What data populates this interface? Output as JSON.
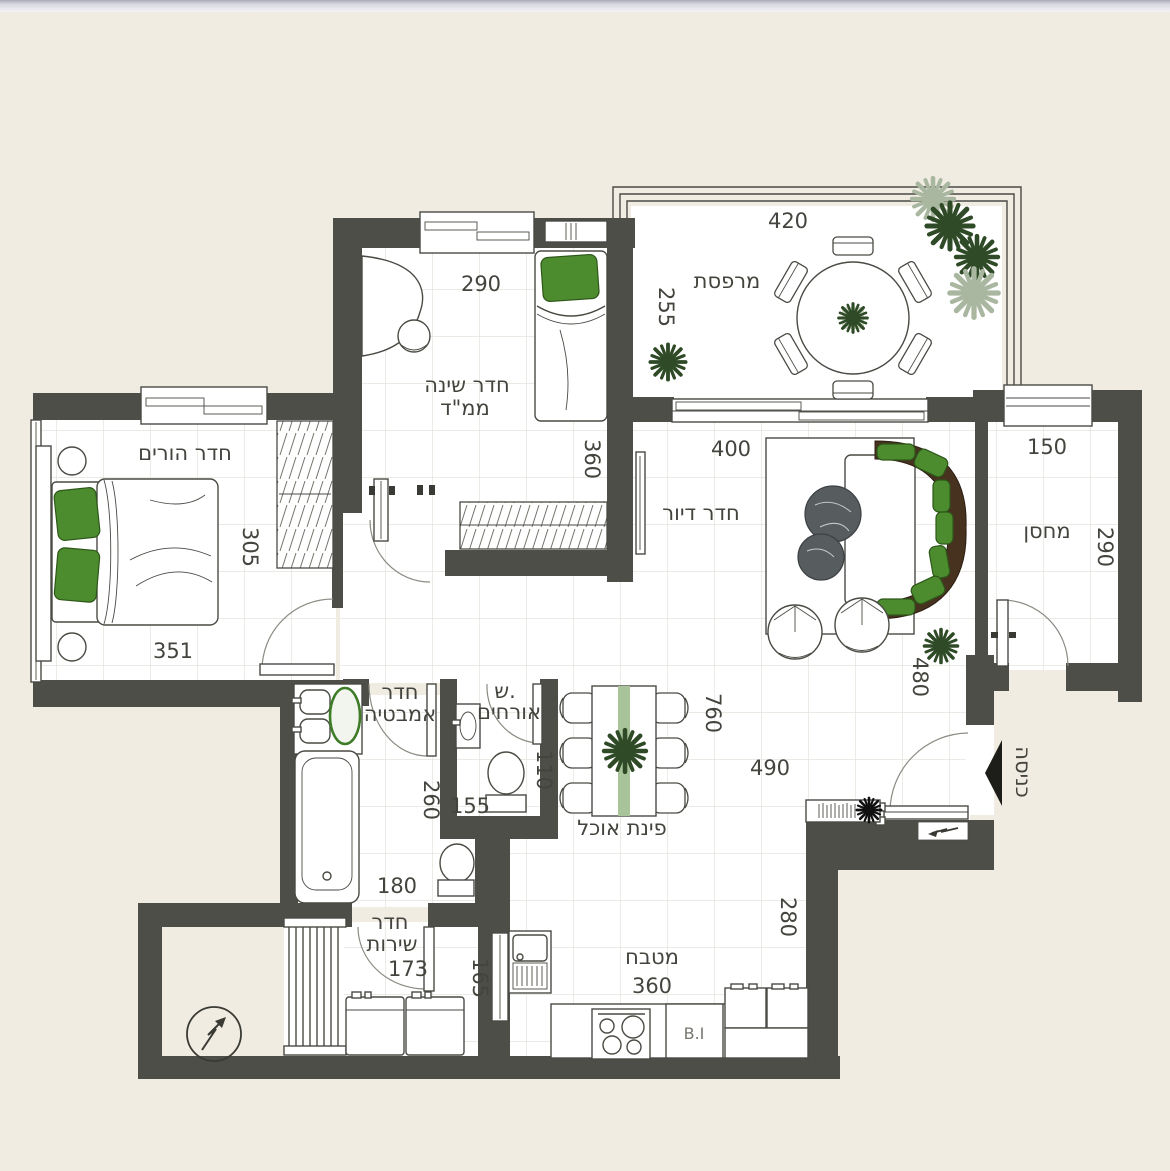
{
  "window_chrome": {
    "top_bar": true
  },
  "colors": {
    "background": "#f1ece2",
    "wall": "#4e4e48",
    "floor": "#ffffff",
    "grid_line": "#e1ded6",
    "line": "#4a4a44",
    "text": "#44443e",
    "green": "#4c8c2f",
    "green_dark": "#2e5719",
    "sofa_back": "#46321f",
    "marble": "#575c5e",
    "runner": "#a9c49a",
    "mirror_green": "#3e7c28",
    "plant_dark": "#2f4a26",
    "plant_light": "#a9b7a0"
  },
  "rooms": {
    "balcony": {
      "label": "מרפסת",
      "width": "420",
      "depth": "255"
    },
    "safe_bedroom": {
      "label_line1": "חדר שינה",
      "label_line2": "ממ\"ד",
      "width": "290",
      "depth": "360"
    },
    "master_bedroom": {
      "label": "חדר הורים",
      "depth": "305",
      "width": "351"
    },
    "living_room": {
      "label": "חדר דיור",
      "width": "400",
      "depth": "480"
    },
    "storage": {
      "label": "מחסן",
      "width": "150",
      "depth": "290"
    },
    "bathroom": {
      "label_line1": "חדר",
      "label_line2": "אמבטיה",
      "depth": "260",
      "width": "180"
    },
    "guest_wc": {
      "label_line1": "ש.",
      "label_line2": "אורחים",
      "depth": "110",
      "width": "155"
    },
    "dining": {
      "label": "פינת אוכל",
      "hall_depth": "760",
      "hall_width": "490"
    },
    "kitchen": {
      "label": "מטבח",
      "width": "360",
      "depth": "280"
    },
    "service_room": {
      "label_line1": "חדר",
      "label_line2": "שירות",
      "width": "173",
      "depth": "165"
    },
    "entrance": {
      "label": "כניסה"
    },
    "built_in_label": "B.I"
  }
}
